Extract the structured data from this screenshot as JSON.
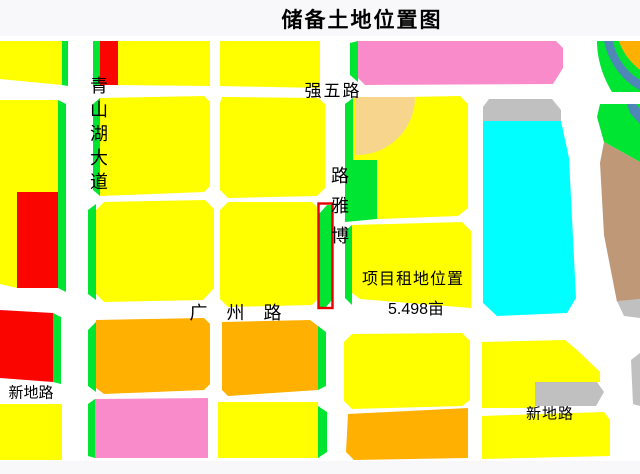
{
  "title": "储备土地位置图",
  "annotation": {
    "project_location": "项目租地位置",
    "project_area": "5.498亩"
  },
  "colors": {
    "yellow": "#FFFF00",
    "green": "#00E532",
    "red": "#FB0500",
    "orange": "#FFB000",
    "pink": "#FA8BCB",
    "wheat": "#F8D58C",
    "cyan": "#00FFFF",
    "gray": "#C0C0C0",
    "tan": "#BF9878",
    "blue": "#4E87B8",
    "highlight": "#E60000",
    "road": "#FFFFFF",
    "page_bg": "#F8F8FA",
    "text": "#000000"
  },
  "map": {
    "labels": [
      {
        "id": "qingshanhu-avenue",
        "text": "青山湖大道",
        "dir": "v",
        "x": 99,
        "y": 86,
        "step": 24,
        "size": 18,
        "reversed": false
      },
      {
        "id": "qiangwu-road",
        "text": "强五路",
        "dir": "h",
        "x": 333,
        "y": 91,
        "size": 17,
        "ls": 2
      },
      {
        "id": "boya-road",
        "text": "博雅路",
        "dir": "v",
        "x": 340,
        "y": 176,
        "step": 30,
        "size": 18,
        "reversed": true
      },
      {
        "id": "guangzhou-road",
        "text": "广州路",
        "dir": "h",
        "x": 245,
        "y": 313,
        "size": 18,
        "ls": 19
      },
      {
        "id": "project-location-note",
        "text": "项目租地位置",
        "dir": "h",
        "x": 413,
        "y": 280,
        "size": 16,
        "ls": 1
      },
      {
        "id": "project-area-note",
        "text": "5.498亩",
        "dir": "h",
        "x": 416,
        "y": 310,
        "size": 16,
        "ls": 0
      },
      {
        "id": "xindi-road-west",
        "text": "新地路",
        "dir": "h",
        "x": 31,
        "y": 393,
        "size": 15,
        "ls": 0
      },
      {
        "id": "xindi-road-east",
        "text": "新地路",
        "dir": "h",
        "x": 550,
        "y": 414,
        "size": 15,
        "ls": 1
      }
    ],
    "highlight": {
      "x": 318.5,
      "y": 203.5,
      "w": 14,
      "h": 104.5,
      "stroke_width": 2.4
    },
    "parcels": [
      {
        "id": "nw-block",
        "fill": "yellow",
        "points": "0,41 62,41 62,85 0,79"
      },
      {
        "id": "nw-block-greenbelt",
        "fill": "green",
        "points": "62,41 68,41 68,86 62,85"
      },
      {
        "id": "n1-greenbelt",
        "fill": "green",
        "points": "93,41 100,41 100,85 93,87"
      },
      {
        "id": "n1-red",
        "fill": "red",
        "points": "100,41 118,41 118,85 100,85"
      },
      {
        "id": "n1-yellow",
        "fill": "yellow",
        "points": "118,41 210,41 210,86 118,85"
      },
      {
        "id": "n2-yellow",
        "fill": "yellow",
        "points": "220,41 320,41 320,88 220,86"
      },
      {
        "id": "n3-greenbelt",
        "fill": "green",
        "points": "350,43 358,41 358,82 350,75"
      },
      {
        "id": "n3-pink",
        "fill": "pink",
        "points": "358,41 556,41 563,48 563,68 553,84 365,85 358,78"
      },
      {
        "id": "ne-greenbelt",
        "fill": "green",
        "d": "M597,41 L640,41 L640,92 L612,92 C601,74 597,56 597,41 Z"
      },
      {
        "id": "ne-river",
        "fill": "blue",
        "d": "M604,41 L613,41 C616,58 627,72 640,80 L640,90 C622,81 608,61 604,41 Z"
      },
      {
        "id": "ne-orange",
        "fill": "orange",
        "d": "M619,41 L640,41 L640,70 C629,61 622,51 619,41 Z"
      },
      {
        "id": "w1-yellow",
        "fill": "yellow",
        "points": "0,100 58,100 58,192 17,192 17,288 0,284"
      },
      {
        "id": "w1-red",
        "fill": "red",
        "points": "17,192 58,192 58,288 17,288"
      },
      {
        "id": "w1-greenbelt",
        "fill": "green",
        "points": "58,100 66,104 66,292 58,288"
      },
      {
        "id": "m1-greenbelt",
        "fill": "green",
        "points": "93,104 100,98 100,196 93,190"
      },
      {
        "id": "m1-yellow",
        "fill": "yellow",
        "points": "100,98 204,96 210,102 210,186 204,192 100,196"
      },
      {
        "id": "m2-yellow",
        "fill": "yellow",
        "points": "222,97 318,98 325,104 325,188 317,196 228,198 220,190 220,103"
      },
      {
        "id": "m3-greenbelt",
        "fill": "green",
        "points": "345,104 353,98 353,160 345,164"
      },
      {
        "id": "m3-yellow",
        "fill": "yellow",
        "points": "353,98 460,96 468,104 468,208 458,216 377,219 377,160 353,160"
      },
      {
        "id": "m3-wheat",
        "fill": "wheat",
        "d": "M355,97 L415,97 A58,58 0 0 1 355,155 Z"
      },
      {
        "id": "m3-green-notch",
        "fill": "green",
        "points": "345,160 377,160 377,219 345,222"
      },
      {
        "id": "lake-gray-edge",
        "fill": "gray",
        "points": "489,99 552,99 561,110 561,121 483,121 483,107"
      },
      {
        "id": "lake-cyan",
        "fill": "cyan",
        "points": "483,121 561,121 569,158 576,298 567,313 497,316 483,303"
      },
      {
        "id": "e1-greenbelt",
        "fill": "green",
        "points": "600,104 640,104 640,162 604,142 597,117"
      },
      {
        "id": "e1-river",
        "fill": "blue",
        "points": "627,104 636,104 640,109 640,124 630,113"
      },
      {
        "id": "e1-tan",
        "fill": "tan",
        "points": "604,142 640,162 640,299 617,302 604,235 600,163"
      },
      {
        "id": "e1-gray",
        "fill": "gray",
        "points": "617,301 640,299 640,318 624,316"
      },
      {
        "id": "c1-greenbelt",
        "fill": "green",
        "points": "88,210 96,204 96,300 88,294"
      },
      {
        "id": "c1-yellow",
        "fill": "yellow",
        "points": "104,202 205,200 214,209 214,288 203,300 104,302 96,294 96,210"
      },
      {
        "id": "c2-yellow",
        "fill": "yellow",
        "points": "228,202 312,202 319,209 319,298 312,305 228,307 220,299 220,210"
      },
      {
        "id": "project-parcel-green",
        "fill": "green",
        "points": "319,214 327,205 332,205 332,300 326,307 319,307"
      },
      {
        "id": "c3-greenbelt",
        "fill": "green",
        "points": "345,231 352,225 352,305 345,298"
      },
      {
        "id": "c3-yellow",
        "fill": "yellow",
        "points": "352,225 462,222 471,231 471,308 360,299 352,293"
      },
      {
        "id": "sw-red",
        "fill": "red",
        "points": "0,310 53,313 53,382 0,378"
      },
      {
        "id": "sw-red-greenbelt",
        "fill": "green",
        "points": "53,313 61,317 61,384 53,382"
      },
      {
        "id": "s1-greenbelt",
        "fill": "green",
        "points": "88,330 96,322 96,392 88,386"
      },
      {
        "id": "s1-orange",
        "fill": "orange",
        "points": "96,320 204,318 210,324 210,384 204,390 104,394 96,388"
      },
      {
        "id": "s2-orange",
        "fill": "orange",
        "points": "222,322 310,320 318,326 318,390 228,396 222,390"
      },
      {
        "id": "s2-greenbelt",
        "fill": "green",
        "points": "318,326 326,332 326,386 318,390"
      },
      {
        "id": "sw2-yellow",
        "fill": "yellow",
        "points": "0,404 62,404 62,460 0,460"
      },
      {
        "id": "s3-greenbelt",
        "fill": "green",
        "points": "88,404 95,399 95,458 88,456"
      },
      {
        "id": "s3-pink",
        "fill": "pink",
        "points": "95,399 208,398 208,458 95,458"
      },
      {
        "id": "s4-yellow",
        "fill": "yellow",
        "points": "218,402 318,402 318,458 218,458"
      },
      {
        "id": "s4-greenbelt",
        "fill": "green",
        "points": "318,406 327,412 327,452 318,458"
      },
      {
        "id": "se1-yellow",
        "fill": "yellow",
        "points": "352,334 462,333 470,341 470,400 462,406 352,409 344,401 344,342"
      },
      {
        "id": "se2-yellow",
        "fill": "yellow",
        "points": "482,342 565,340 577,350 600,372 600,382 535,382 535,408 482,408"
      },
      {
        "id": "se2-gray",
        "fill": "gray",
        "points": "535,382 597,382 604,392 596,406 535,406"
      },
      {
        "id": "se3-orange",
        "fill": "orange",
        "points": "348,414 468,408 468,458 354,460 346,452"
      },
      {
        "id": "se4-yellow",
        "fill": "yellow",
        "points": "482,416 604,412 610,420 610,456 482,459"
      },
      {
        "id": "se-gray-sliver",
        "fill": "gray",
        "points": "631,360 640,353 640,406 633,404"
      }
    ]
  }
}
